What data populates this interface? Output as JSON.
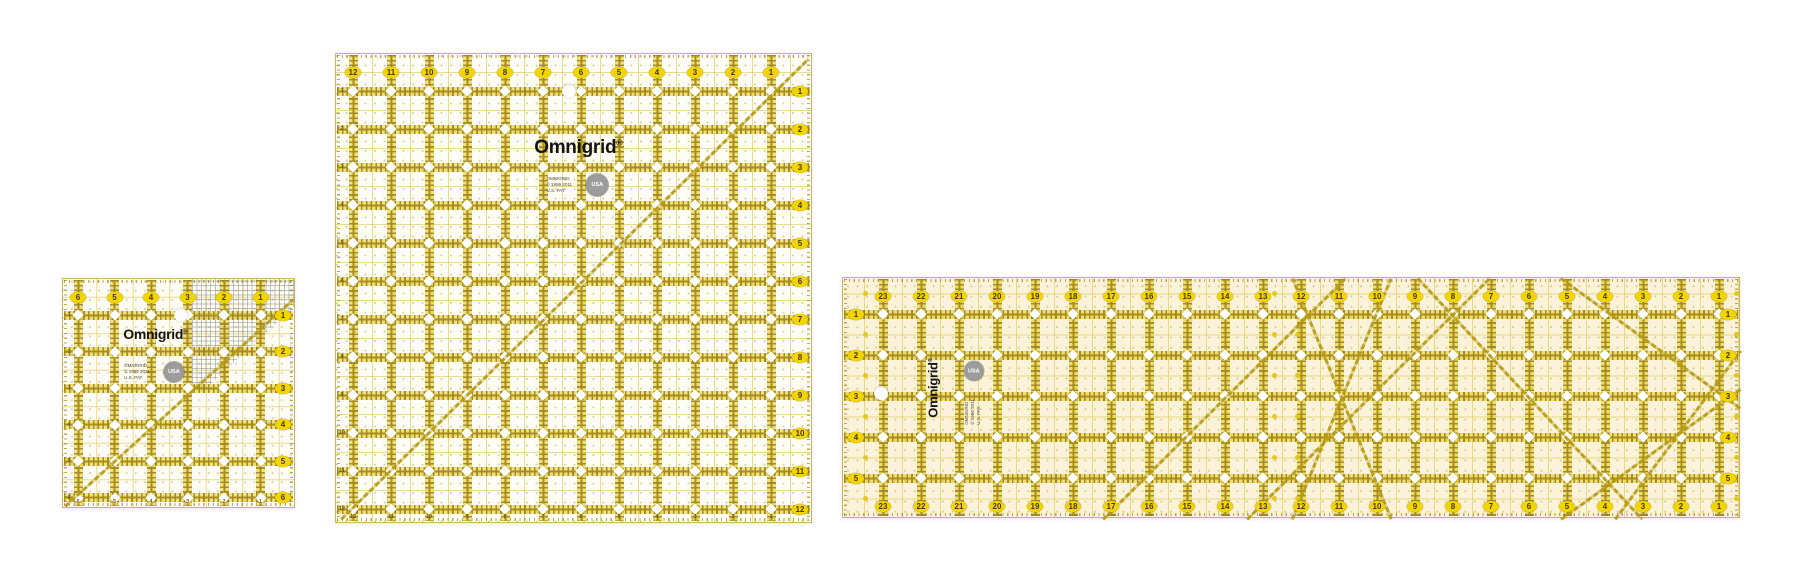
{
  "scene": {
    "width": 1807,
    "height": 570,
    "background": "#ffffff"
  },
  "colors": {
    "grid_yellow": "#d5bc2c",
    "tick_olive": "#8c7510",
    "oval_yellow": "#f2d402",
    "oval_text": "#453a06",
    "logo_black": "#141414",
    "badge_gray": "#8e8e8e",
    "crosshatch_gray": "#7d7d7d"
  },
  "rulers": [
    {
      "id": "small-square-ruler",
      "frame": {
        "x": 62,
        "y": 278,
        "w": 233,
        "h": 230
      },
      "tint": "rgba(253,252,244,0.96)",
      "grid": {
        "padL": 15,
        "padT": 36,
        "cellX": 36.5,
        "cellY": 36.5,
        "v": 6,
        "h": 6
      },
      "numbers": {
        "top": [
          "6",
          "5",
          "4",
          "3",
          "2",
          "1"
        ],
        "right": [
          "1",
          "2",
          "3",
          "4",
          "5",
          "6"
        ],
        "left_minor": [
          "1",
          "2",
          "3",
          "4",
          "5",
          "6"
        ],
        "bottom_minor": [
          "6",
          "5",
          "4",
          "3",
          "2",
          "1"
        ]
      },
      "logo": {
        "text": "Omnigrid",
        "mark": "®",
        "x": 40,
        "y": 24,
        "size": 14,
        "rot": false
      },
      "badge": {
        "text": "USA",
        "x": 48,
        "y": 41,
        "d": 20
      },
      "fine_print": {
        "lines": [
          "OMNIGRID",
          "© 1986 2011",
          "U.S. PAT."
        ],
        "x": 32,
        "y": 41,
        "rot": false
      },
      "hole": {
        "x": 51,
        "y": 16
      },
      "lines": [
        {
          "x1": 1,
          "y1": 99,
          "x2": 99,
          "y2": 9
        }
      ],
      "gray_region": "polygon(54% 0%, 100% 0%, 100% 12%, 62% 48%, 54% 48%)",
      "dot_columns": []
    },
    {
      "id": "large-square-ruler",
      "frame": {
        "x": 335,
        "y": 53,
        "w": 477,
        "h": 470
      },
      "tint": "rgba(253,252,245,0.96)",
      "grid": {
        "padL": 17,
        "padT": 37,
        "cellX": 38,
        "cellY": 38,
        "v": 12,
        "h": 12
      },
      "numbers": {
        "top": [
          "12",
          "11",
          "10",
          "9",
          "8",
          "7",
          "6",
          "5",
          "4",
          "3",
          "2",
          "1"
        ],
        "right": [
          "1",
          "2",
          "3",
          "4",
          "5",
          "6",
          "7",
          "8",
          "9",
          "10",
          "11",
          "12"
        ],
        "left_minor": [
          "1",
          "2",
          "3",
          "4",
          "5",
          "6",
          "7",
          "8",
          "9",
          "10",
          "11",
          "12"
        ],
        "bottom_minor": [
          "12",
          "11",
          "10",
          "9",
          "8",
          "7",
          "6",
          "5",
          "4",
          "3",
          "2",
          "1"
        ]
      },
      "logo": {
        "text": "Omnigrid",
        "mark": "®",
        "x": 51,
        "y": 20,
        "size": 19,
        "rot": false
      },
      "badge": {
        "text": "USA",
        "x": 55,
        "y": 28,
        "d": 22
      },
      "fine_print": {
        "lines": [
          "OMNIGRID",
          "© 1986 2011",
          "U.S. PAT."
        ],
        "x": 47,
        "y": 28,
        "rot": false
      },
      "hole": {
        "x": 49,
        "y": 8
      },
      "lines": [
        {
          "x1": 1,
          "y1": 99,
          "x2": 99,
          "y2": 1
        }
      ],
      "gray_region": null,
      "dot_columns": []
    },
    {
      "id": "long-rectangle-ruler",
      "frame": {
        "x": 842,
        "y": 277,
        "w": 898,
        "h": 241
      },
      "tint": "rgba(250,243,216,0.97)",
      "grid": {
        "padL": 40,
        "padT": 36,
        "cellX": 38,
        "cellY": 41,
        "v": 23,
        "h": 5
      },
      "numbers": {
        "top": [
          "23",
          "22",
          "21",
          "20",
          "19",
          "18",
          "17",
          "16",
          "15",
          "14",
          "13",
          "12",
          "11",
          "10",
          "9",
          "8",
          "7",
          "6",
          "5",
          "4",
          "3",
          "2",
          "1"
        ],
        "bottom": [
          "23",
          "22",
          "21",
          "20",
          "19",
          "18",
          "17",
          "16",
          "15",
          "14",
          "13",
          "12",
          "11",
          "10",
          "9",
          "8",
          "7",
          "6",
          "5",
          "4",
          "3",
          "2",
          "1"
        ],
        "left": [
          "1",
          "2",
          "3",
          "4",
          "5"
        ],
        "right": [
          "1",
          "2",
          "3",
          "4",
          "5"
        ]
      },
      "logo": {
        "text": "Omnigrid",
        "mark": "®",
        "x": 10,
        "y": 46,
        "size": 13,
        "rot": true
      },
      "badge": {
        "text": "USA",
        "x": 14.6,
        "y": 39,
        "d": 19
      },
      "fine_print": {
        "lines": [
          "OMNIGRID",
          "© 1986 2011",
          "U.S. PAT."
        ],
        "x": 14.5,
        "y": 56,
        "rot": true
      },
      "hole": {
        "x": 4.2,
        "y": 48
      },
      "lines": [
        {
          "x1": 29,
          "y1": 100,
          "x2": 56,
          "y2": 0
        },
        {
          "x1": 45,
          "y1": 100,
          "x2": 72,
          "y2": 0
        },
        {
          "x1": 50,
          "y1": 100,
          "x2": 61,
          "y2": 0
        },
        {
          "x1": 61,
          "y1": 100,
          "x2": 50,
          "y2": 0
        },
        {
          "x1": 64,
          "y1": 0,
          "x2": 89,
          "y2": 100
        },
        {
          "x1": 80,
          "y1": 100,
          "x2": 100,
          "y2": 46
        },
        {
          "x1": 80,
          "y1": 0,
          "x2": 100,
          "y2": 54
        },
        {
          "x1": 86,
          "y1": 100,
          "x2": 100,
          "y2": 30
        }
      ],
      "gray_region": null,
      "dot_columns": [
        -0.47,
        10.3,
        10.9,
        22.45
      ]
    }
  ]
}
